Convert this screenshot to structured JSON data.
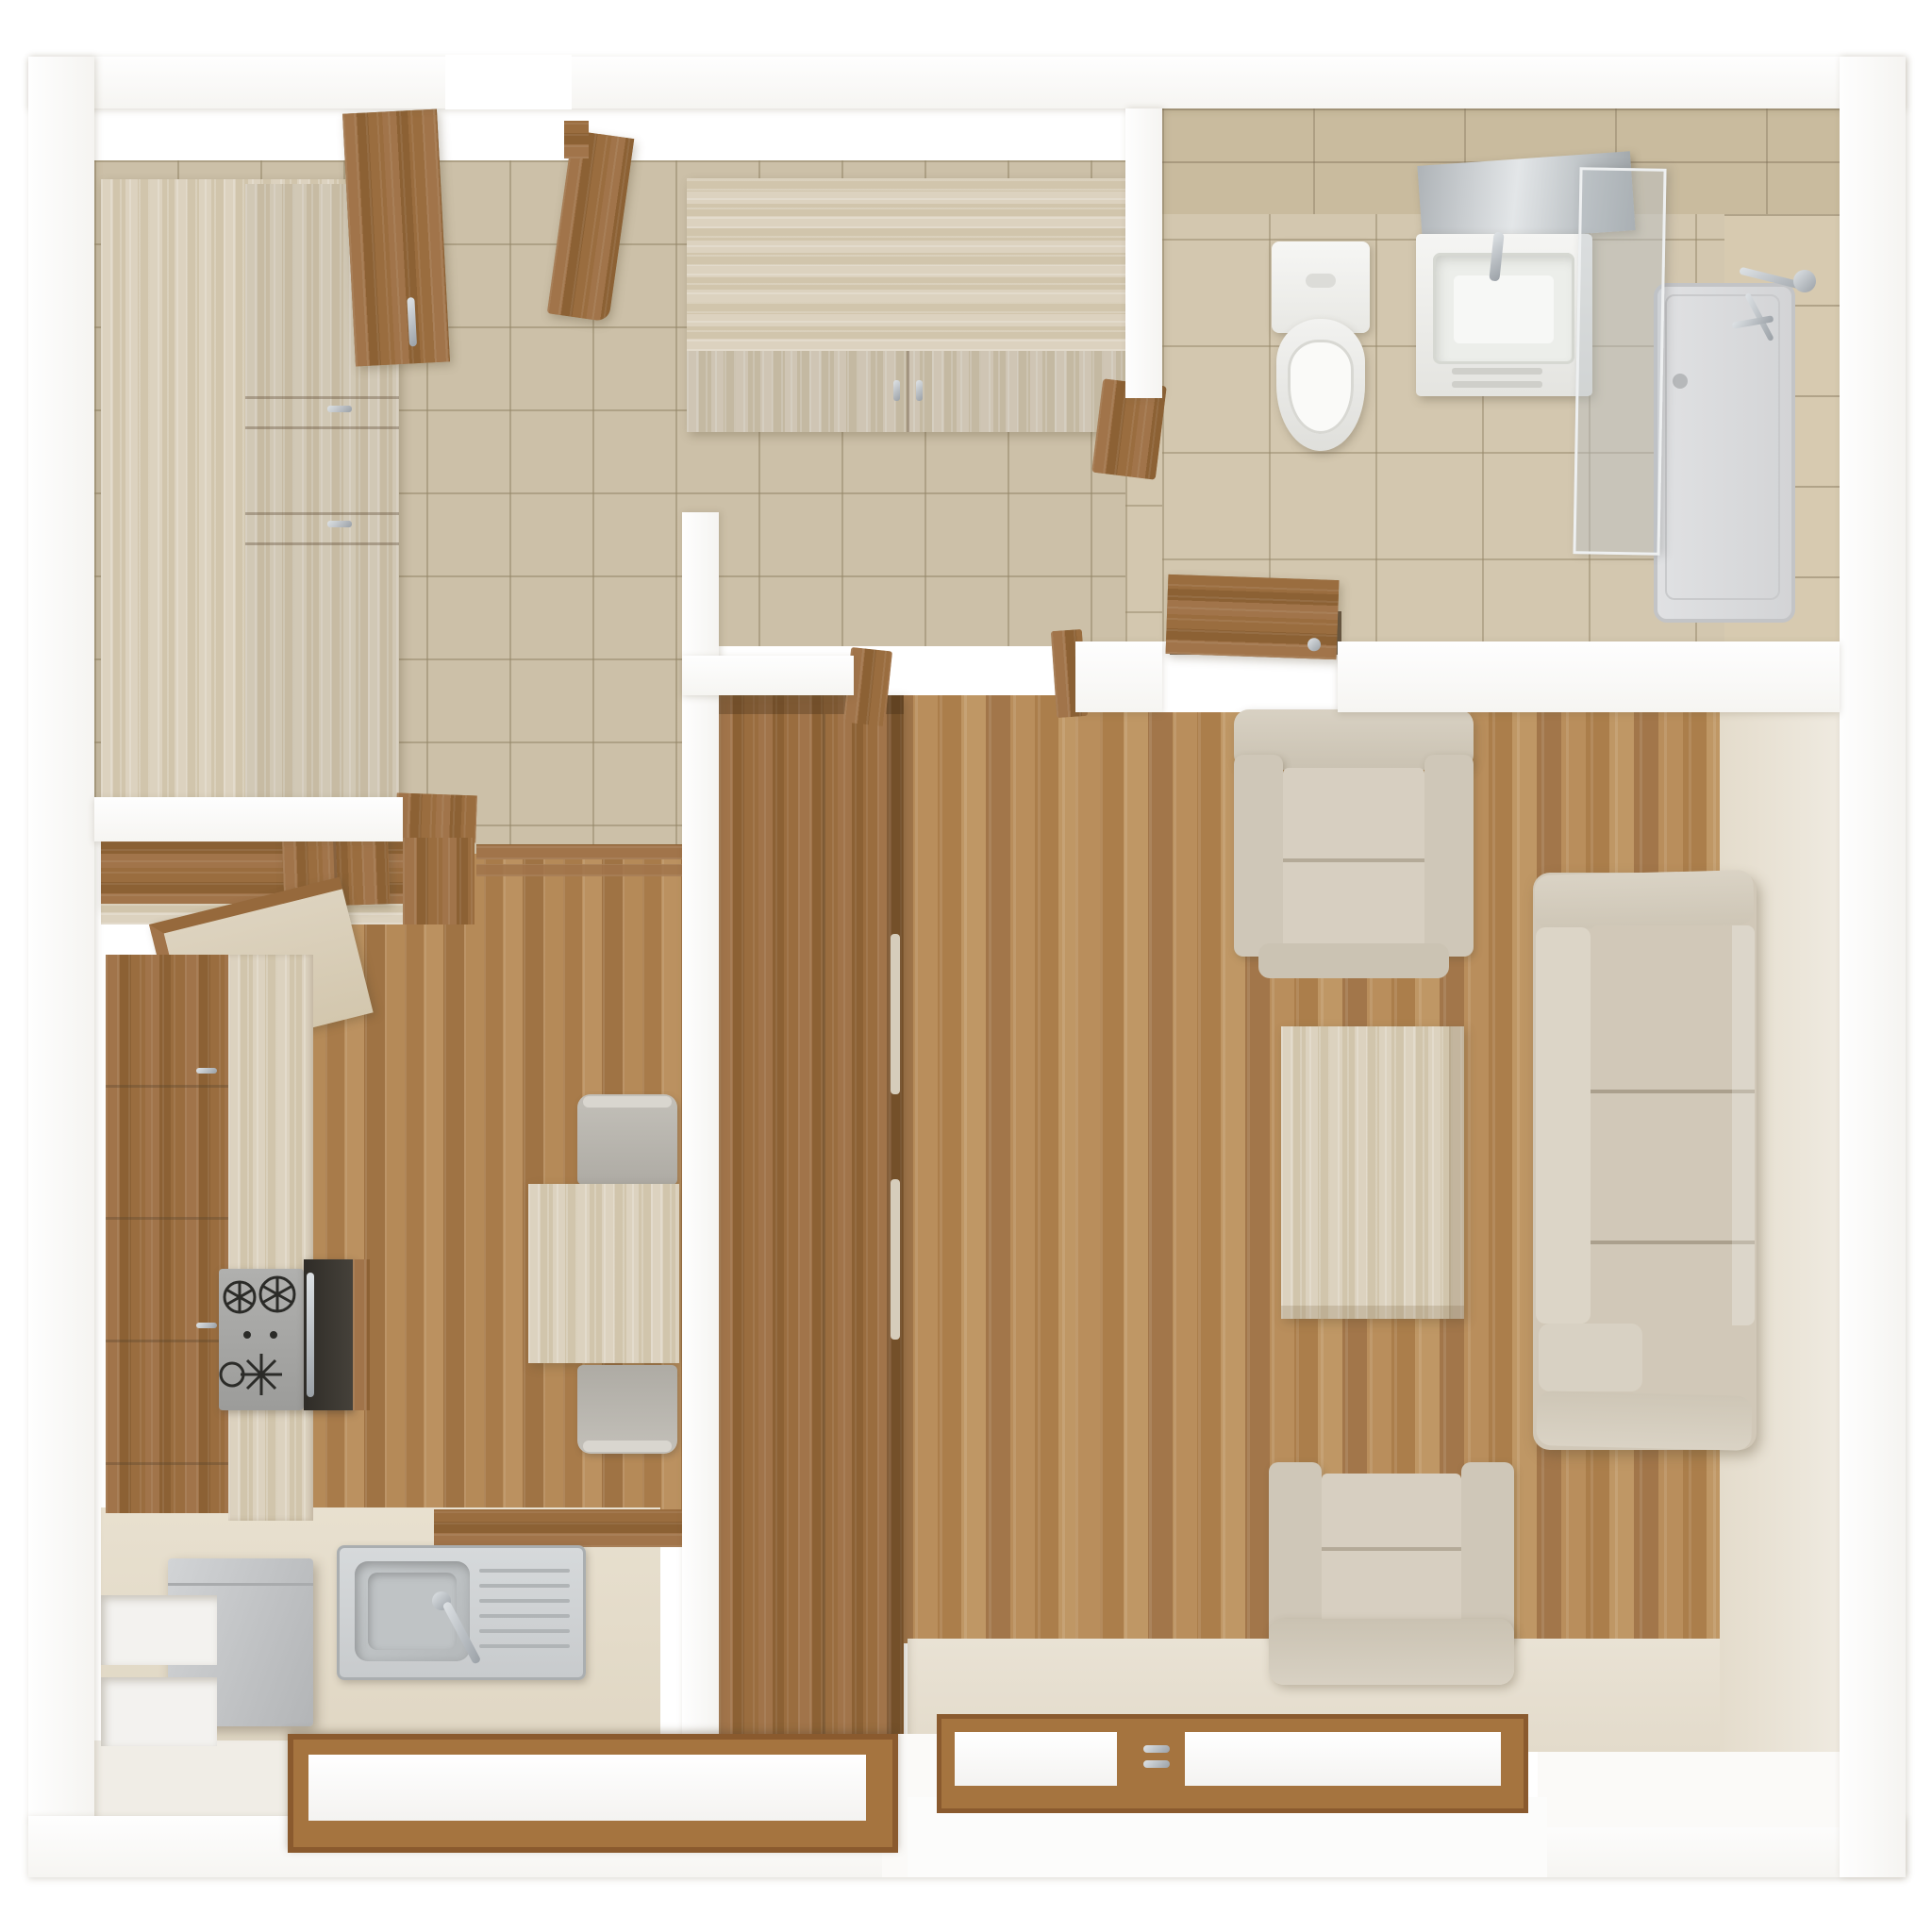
{
  "scene": {
    "kind": "3d-floor-plan-top-view",
    "description": "Top-down 3D render of a one-bedroom apartment: tiled entry hallway, bathroom (top right), kitchen with dining nook (bottom left), living room (right).",
    "rooms": [
      {
        "name": "hallway",
        "floor": "beige-ceramic-tile",
        "furniture": [
          "tall-wardrobe",
          "open-wardrobe-door",
          "entry-door",
          "storage-cabinet"
        ]
      },
      {
        "name": "bathroom",
        "floor": "beige-ceramic-tile",
        "furniture": [
          "toilet",
          "vanity-sink",
          "mirror",
          "shower-glass-panel",
          "shower-tray",
          "shower-fixture",
          "bathroom-door"
        ]
      },
      {
        "name": "kitchen",
        "floor": "oak-plank",
        "furniture": [
          "upper-cabinets",
          "cooker-hood",
          "base-cabinets",
          "counter",
          "cooktop",
          "oven",
          "sink",
          "refrigerator",
          "dining-table",
          "dining-chair",
          "dining-chair",
          "window"
        ]
      },
      {
        "name": "living-room",
        "floor": "oak-plank",
        "furniture": [
          "tall-wardrobe",
          "sofa-3-seat",
          "armchair",
          "armchair",
          "coffee-table",
          "window",
          "window"
        ]
      }
    ],
    "counts": {
      "windows": 3,
      "doors": 3,
      "armchairs": 2,
      "dining_chairs": 2
    }
  },
  "palette": {
    "wall_white": "#fcfcfb",
    "wall_inner_face": "#e7dfd0",
    "hall_tile": "#ccc0a8",
    "bath_tile": "#d3c7af",
    "oak_wood": "#9a6d3f",
    "pale_wood": "#d8cdb8",
    "floor_plank": "#b1854f",
    "upholstery_beige": "#d1c8b8",
    "chair_grey": "#b6b3ab",
    "stainless": "#ced1d3",
    "appliance_grey": "#c6c8ca",
    "cooktop_grey": "#a6a6a4",
    "oven_black": "#3b3731",
    "sanitary_white": "#f4f4f1",
    "chrome": "#b4bac0",
    "window_frame": "#a5743f",
    "shower_glass": "#c6cbd0"
  }
}
